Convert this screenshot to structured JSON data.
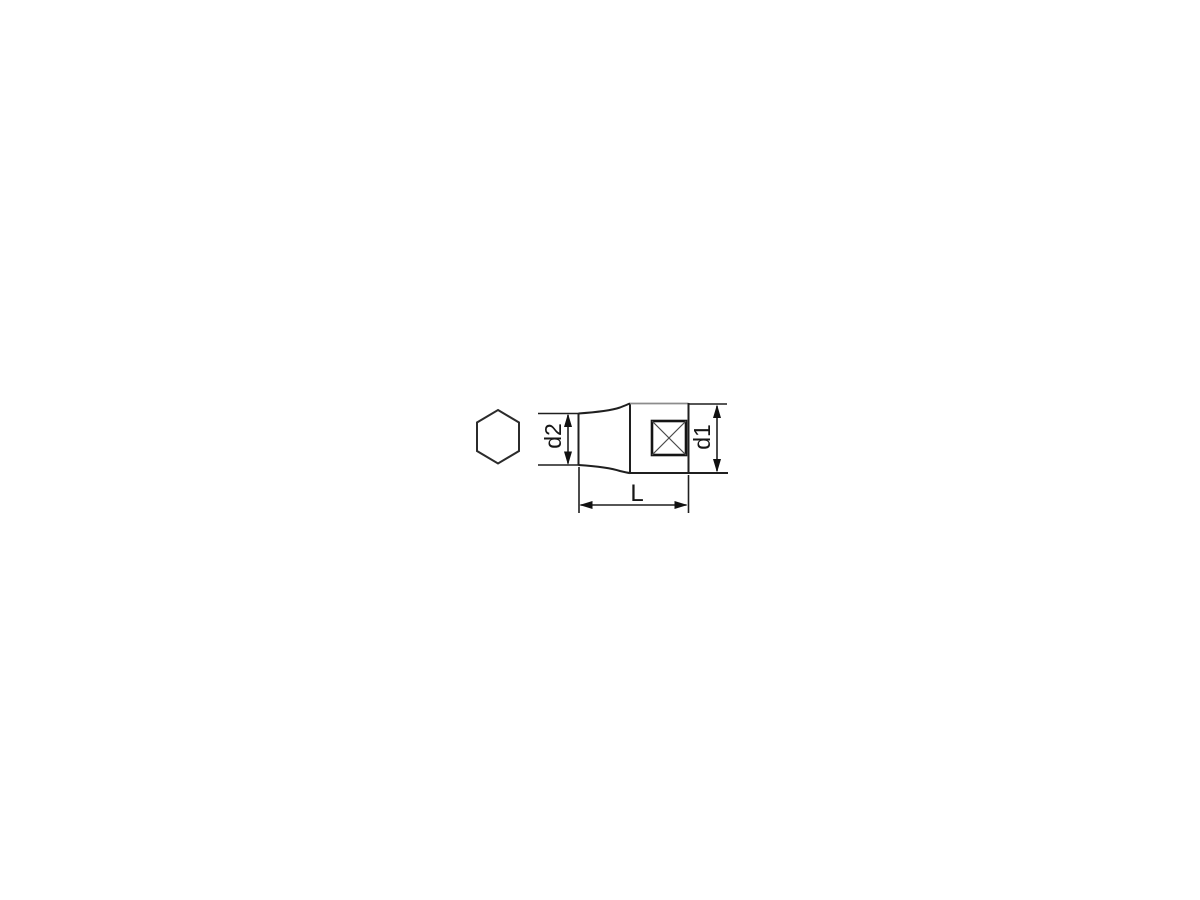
{
  "canvas": {
    "background": "#ffffff",
    "line_color": "#1f1f1f",
    "light_line_color": "#8c8c8c",
    "diagonal_line_color": "#4a4a4a"
  },
  "figure": {
    "description": "Technical line drawing of a square-drive socket: hexagon end view at left, side profile with square drive hole marked by crossed diagonals, and three dimension callouts",
    "hex_view": {
      "shape": "hexagon"
    },
    "side_view": {
      "drive_marker": "square-with-x"
    },
    "dimensions": {
      "d2": {
        "label": "d2",
        "orientation": "vertical"
      },
      "d1": {
        "label": "d1",
        "orientation": "vertical"
      },
      "L": {
        "label": "L",
        "orientation": "horizontal"
      }
    }
  }
}
